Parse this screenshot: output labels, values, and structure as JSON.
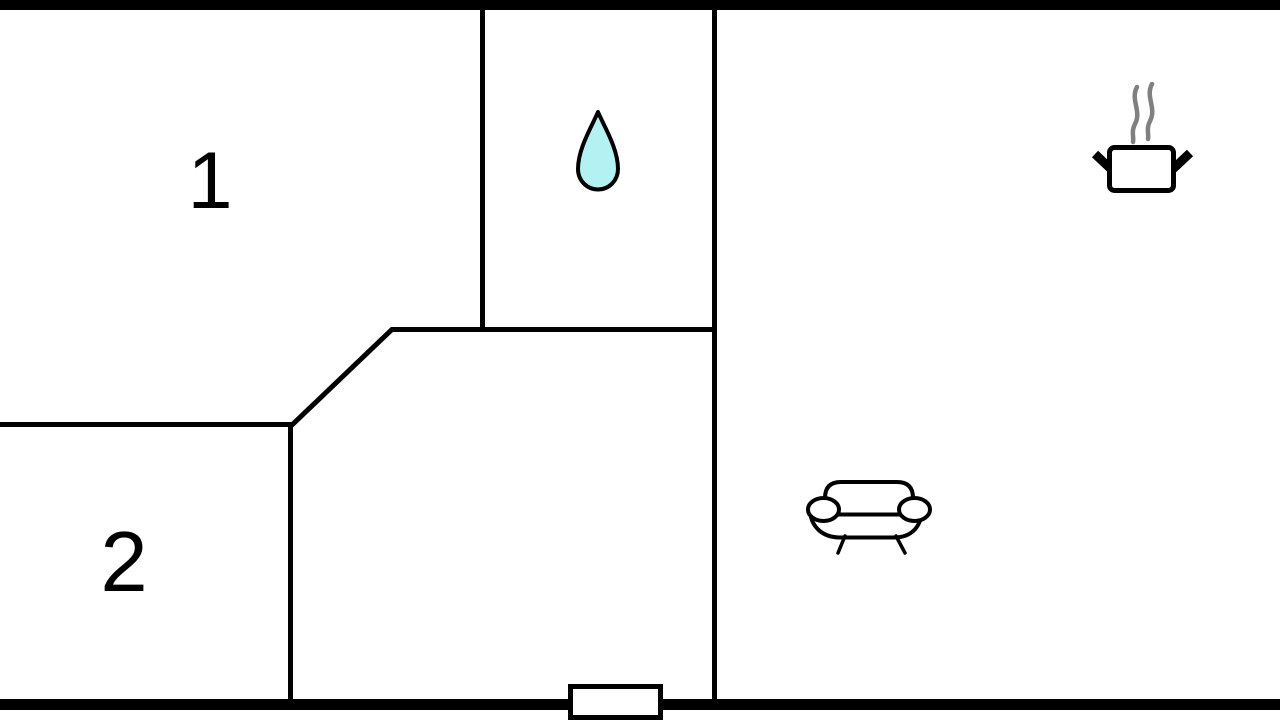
{
  "plan": {
    "type": "floor-plan",
    "rooms": [
      {
        "label": "1"
      },
      {
        "label": "2"
      }
    ],
    "icons": [
      {
        "name": "water-drop-icon"
      },
      {
        "name": "cooking-pot-icon"
      },
      {
        "name": "sofa-icon"
      }
    ],
    "entrance": {
      "name": "entrance-door"
    }
  },
  "colors": {
    "wall": "#000000",
    "background": "#ffffff",
    "outline": "#000000",
    "drop_fill": "#b3f2f2",
    "steam": "#808080",
    "white": "#ffffff"
  }
}
